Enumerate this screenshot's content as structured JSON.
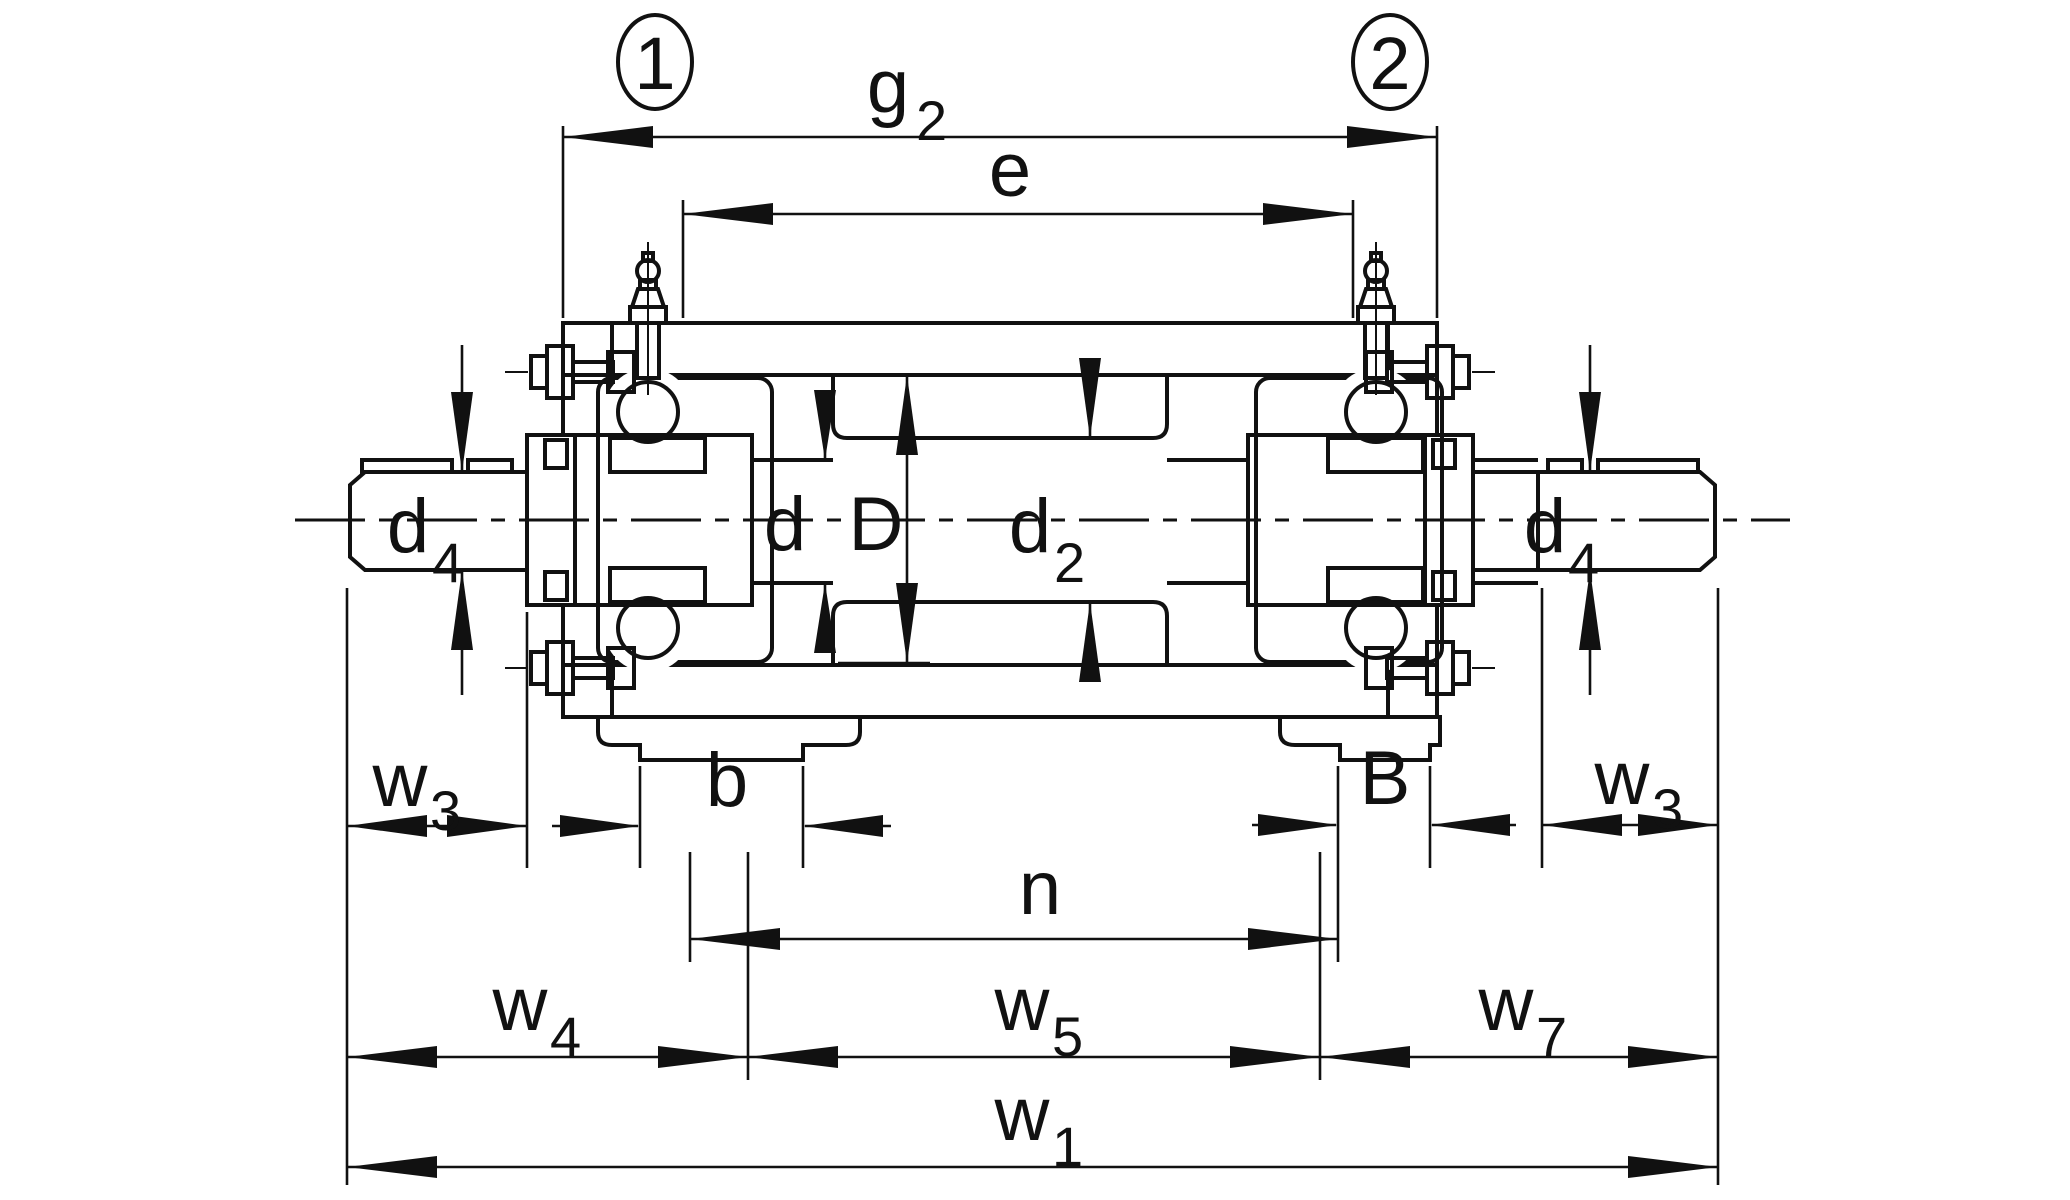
{
  "page": {
    "background": "#ffffff",
    "line_color": "#111111"
  },
  "drawing": {
    "title": "Bearing-supported roller unit cross-section with dimension annotations",
    "callouts": {
      "c1": {
        "label": "1"
      },
      "c2": {
        "label": "2"
      }
    },
    "labels": {
      "g2": {
        "main": "g",
        "sub": "2"
      },
      "e": {
        "main": "e",
        "sub": ""
      },
      "d4_left": {
        "main": "d",
        "sub": "4"
      },
      "d4_right": {
        "main": "d",
        "sub": "4"
      },
      "d": {
        "main": "d",
        "sub": ""
      },
      "D": {
        "main": "D",
        "sub": ""
      },
      "d2": {
        "main": "d",
        "sub": "2"
      },
      "w3_left": {
        "main": "w",
        "sub": "3"
      },
      "b": {
        "main": "b",
        "sub": ""
      },
      "B": {
        "main": "B",
        "sub": ""
      },
      "w3_right": {
        "main": "w",
        "sub": "3"
      },
      "n": {
        "main": "n",
        "sub": ""
      },
      "w4": {
        "main": "w",
        "sub": "4"
      },
      "w5": {
        "main": "w",
        "sub": "5"
      },
      "w7": {
        "main": "w",
        "sub": "7"
      },
      "w1": {
        "main": "w",
        "sub": "1"
      }
    }
  }
}
